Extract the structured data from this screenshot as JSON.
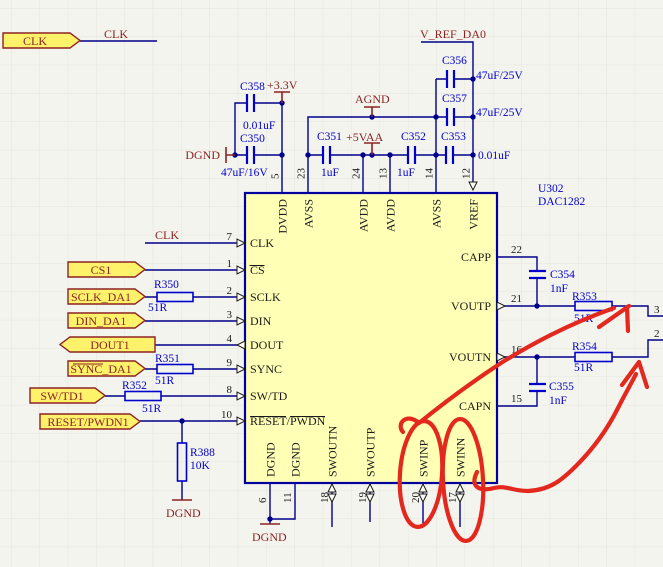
{
  "schematic": {
    "ic": {
      "designator": "U302",
      "part_number": "DAC1282",
      "pins_top": [
        {
          "number": "5",
          "name": "DVDD"
        },
        {
          "number": "23",
          "name": "AVSS"
        },
        {
          "number": "24",
          "name": "AVDD"
        },
        {
          "number": "13",
          "name": "AVDD"
        },
        {
          "number": "14",
          "name": "AVSS"
        },
        {
          "number": "12",
          "name": "VREF"
        }
      ],
      "pins_left": [
        {
          "number": "7",
          "name": "CLK"
        },
        {
          "number": "1",
          "name": "CS"
        },
        {
          "number": "2",
          "name": "SCLK"
        },
        {
          "number": "3",
          "name": "DIN"
        },
        {
          "number": "4",
          "name": "DOUT"
        },
        {
          "number": "9",
          "name": "SYNC"
        },
        {
          "number": "8",
          "name": "SW/TD"
        },
        {
          "number": "10",
          "name": "RESET/PWDN"
        }
      ],
      "pins_right": [
        {
          "number": "22",
          "name": "CAPP"
        },
        {
          "number": "21",
          "name": "VOUTP"
        },
        {
          "number": "16",
          "name": "VOUTN"
        },
        {
          "number": "15",
          "name": "CAPN"
        }
      ],
      "pins_bottom": [
        {
          "number": "6",
          "name": "DGND"
        },
        {
          "number": "11",
          "name": "DGND"
        },
        {
          "number": "18",
          "name": "SWOUTN"
        },
        {
          "number": "19",
          "name": "SWOUTP"
        },
        {
          "number": "20",
          "name": "SWINP"
        },
        {
          "number": "17",
          "name": "SWINN"
        }
      ]
    },
    "ports": {
      "clk": "CLK",
      "cs1": "CS1",
      "sclk": "SCLK_DA1",
      "din": "DIN_DA1",
      "dout": "DOUT1",
      "sync": "SYNC_DA1",
      "swtd": "SW/TD1",
      "reset": "RESET/PWDN1"
    },
    "net_labels": {
      "clk_top": "CLK",
      "clk_pin": "CLK",
      "vref": "V_REF_DA0"
    },
    "power": {
      "p3v3": "+3.3V",
      "p5vaa": "+5VAA",
      "agnd": "AGND",
      "dgnd_top": "DGND",
      "dgnd_r388": "DGND",
      "dgnd_ic": "DGND"
    },
    "resistors": {
      "r350": {
        "ref": "R350",
        "value": "51R"
      },
      "r351": {
        "ref": "R351",
        "value": "51R"
      },
      "r352": {
        "ref": "R352",
        "value": "51R"
      },
      "r353": {
        "ref": "R353",
        "value": "51R"
      },
      "r354": {
        "ref": "R354",
        "value": "51R"
      },
      "r388": {
        "ref": "R388",
        "value": "10K"
      }
    },
    "capacitors": {
      "c350": {
        "ref": "C350",
        "value": "47uF/16V"
      },
      "c351": {
        "ref": "C351",
        "value": "1uF"
      },
      "c352": {
        "ref": "C352",
        "value": "1uF"
      },
      "c353": {
        "ref": "C353",
        "value": "0.01uF"
      },
      "c354": {
        "ref": "C354",
        "value": "1nF"
      },
      "c355": {
        "ref": "C355",
        "value": "1nF"
      },
      "c356": {
        "ref": "C356",
        "value": "47uF/25V"
      },
      "c357": {
        "ref": "C357",
        "value": "47uF/25V"
      },
      "c358": {
        "ref": "C358",
        "value": "0.01uF"
      }
    },
    "offsheet": {
      "upper_pin": "3",
      "lower_pin": "2"
    },
    "colors": {
      "wire": "#00008c",
      "symbol": "#0000cd",
      "net_text": "#8b2323",
      "ic_fill": "#ffffb5",
      "ic_border": "#0000a0",
      "port_fill": "#fff26b",
      "annotation_red": "#e3281e",
      "background": "#f4f4ef",
      "grid": "#e6e6de"
    }
  }
}
